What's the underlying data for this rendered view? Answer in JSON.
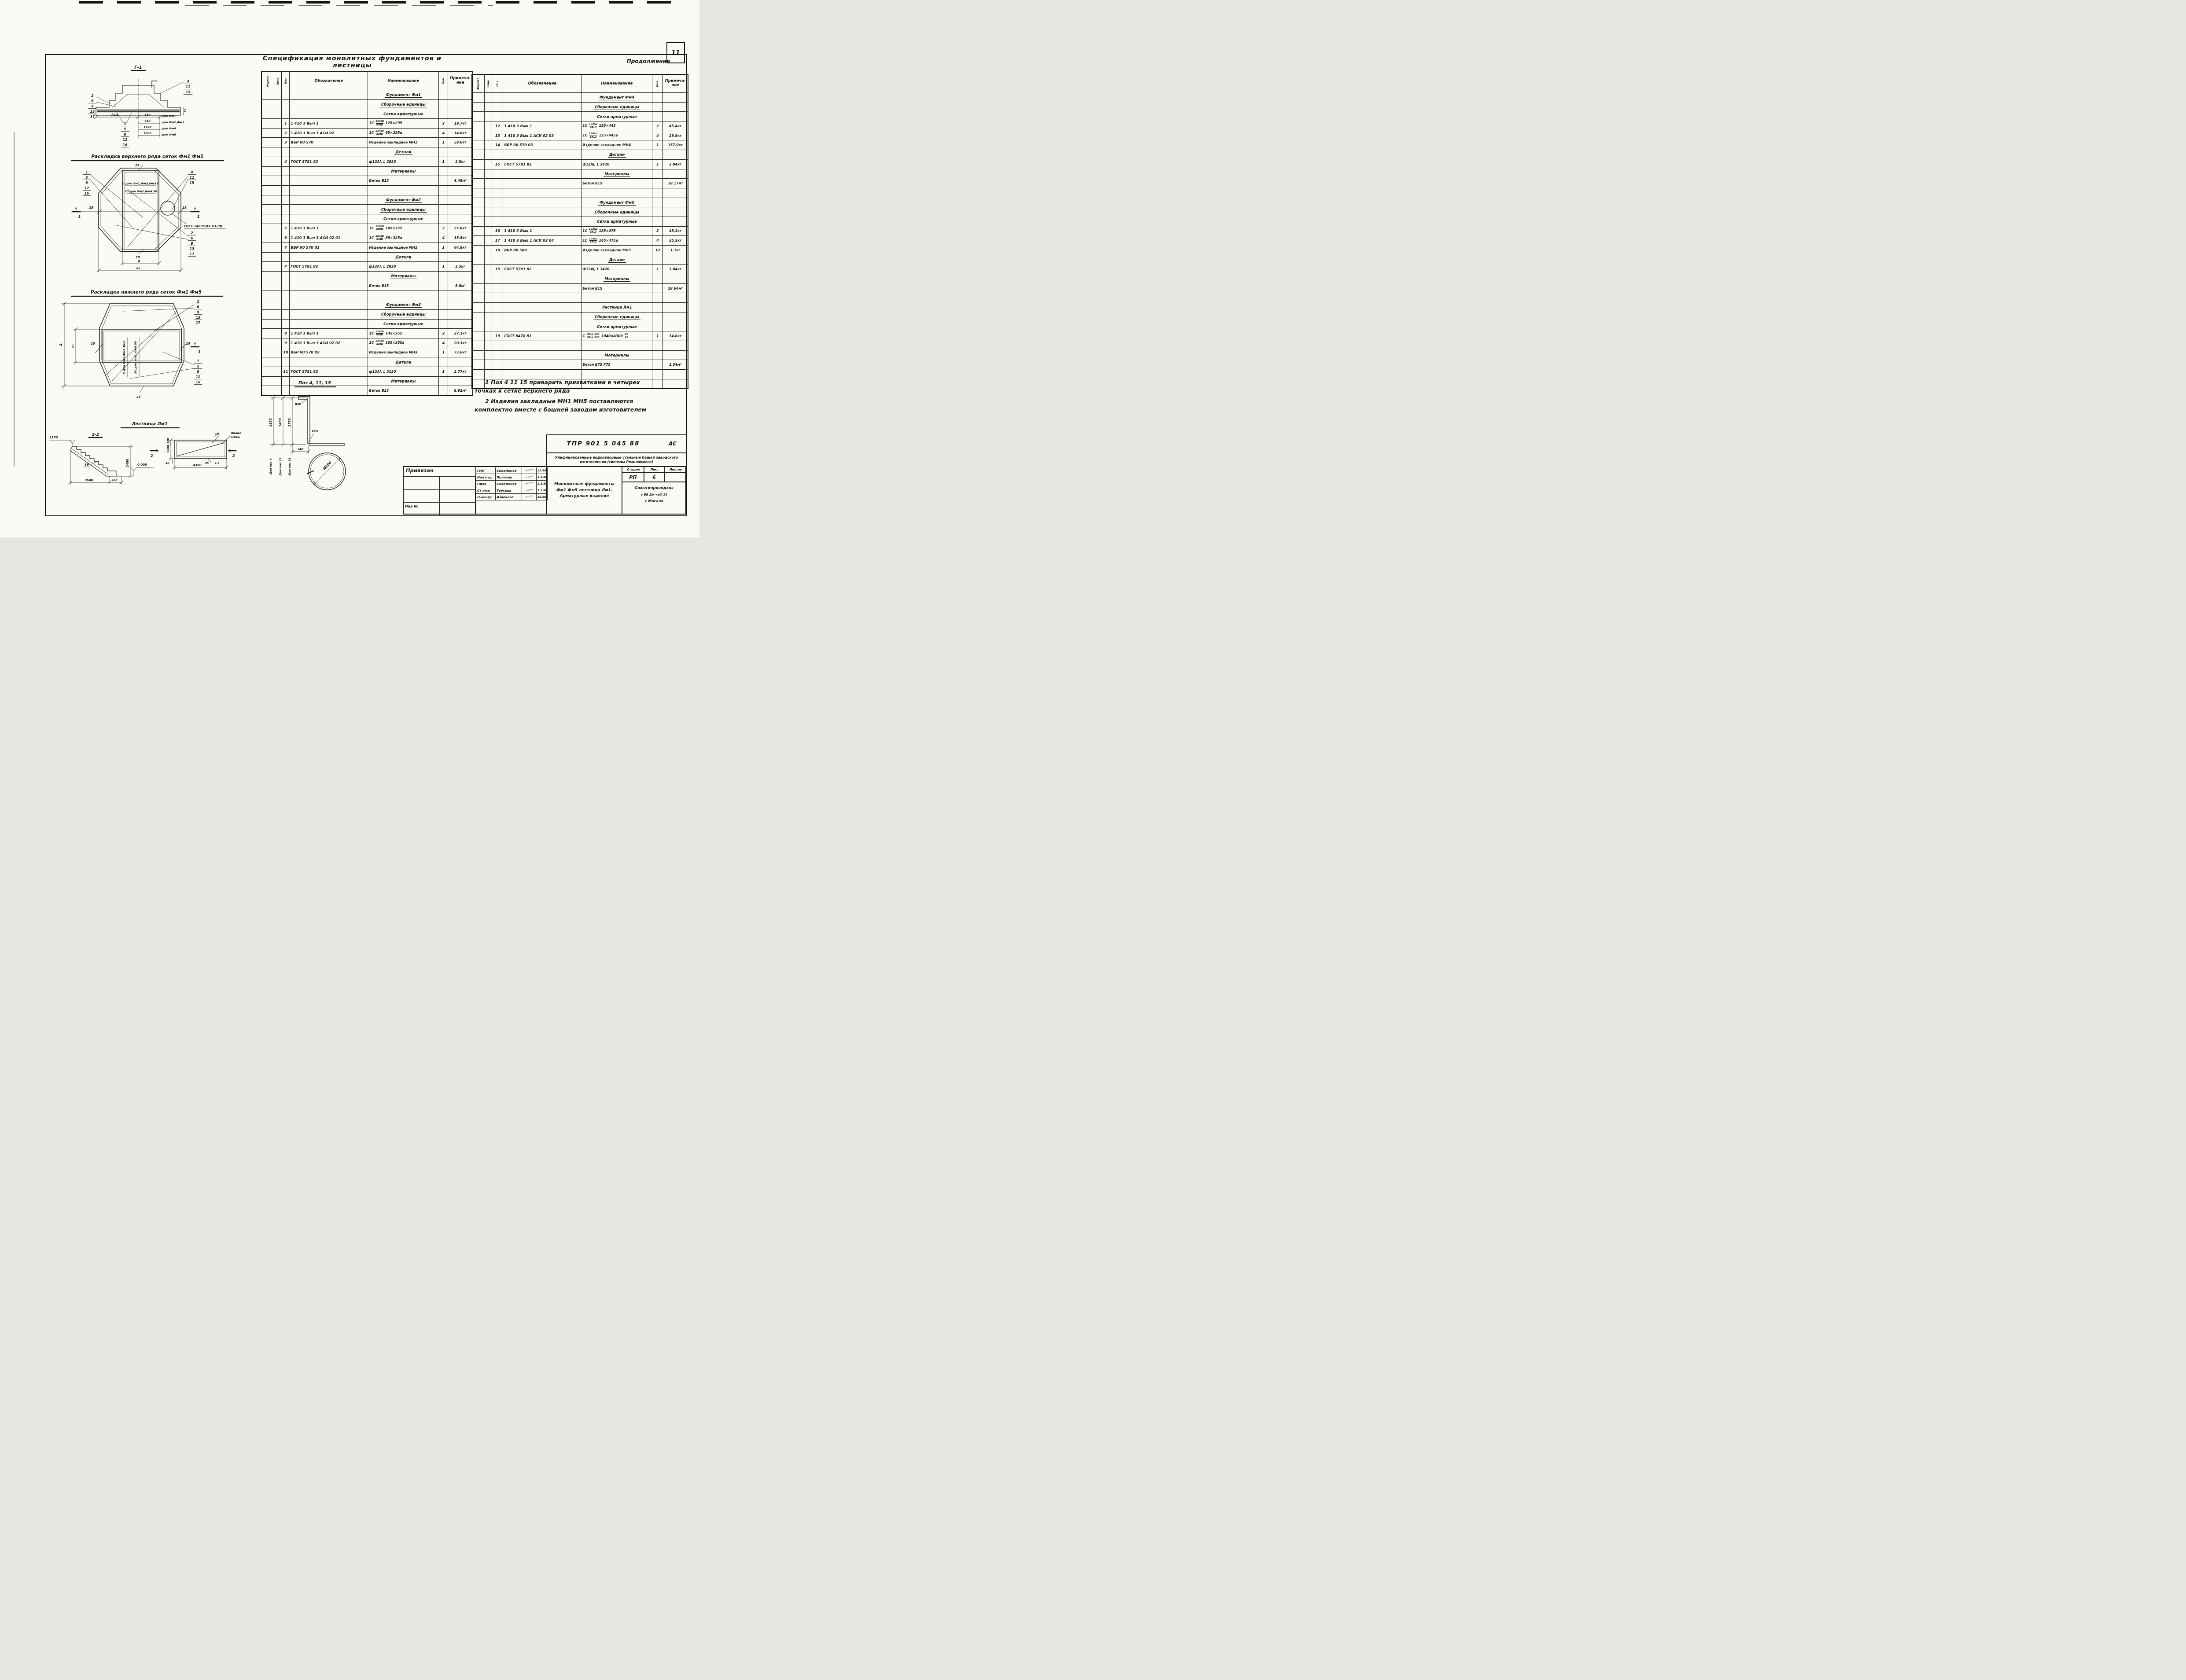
{
  "page": {
    "number": "11",
    "continuation_label": "Продолжение",
    "title": "Спецификация монолитных фундаментов и лестницы"
  },
  "spec_table": {
    "headers": {
      "format": "Формат",
      "zona": "Зона",
      "poz": "Поз",
      "oboznachenie": "Обозначение",
      "naimenovanie": "Наименование",
      "kol": "Кол",
      "primechanie": "Примеча-\nние"
    },
    "left_rows": [
      {
        "t": "s",
        "na": "Фундамент Фм1"
      },
      {
        "t": "s",
        "na": "Сборочные единицы"
      },
      {
        "t": "sp",
        "na": "Сетки арматурные"
      },
      {
        "t": "i",
        "poz": "1",
        "ob": "1 410 3 Вып 1",
        "na": "1С {12АШ|6АШ} 125×295",
        "kol": "2",
        "pr": "19.7кг"
      },
      {
        "t": "i",
        "poz": "2",
        "ob": "1 410 3 Вып 1  АСИ 02",
        "na": "1С {12АШ|6АШ} 85×295а",
        "kol": "4",
        "pr": "14.0кг"
      },
      {
        "t": "i",
        "poz": "3",
        "ob": "ВБР 00 570",
        "na": "Изделие закладное МН1",
        "kol": "1",
        "pr": "58.0кг"
      },
      {
        "t": "s",
        "na": "Детали"
      },
      {
        "t": "i",
        "poz": "4",
        "ob": "ГОСТ 5781 82",
        "na": "ф12АI, L 2820",
        "kol": "1",
        "pr": "2.5кг"
      },
      {
        "t": "s",
        "na": "Материалы"
      },
      {
        "t": "m",
        "na": "Бетон В15",
        "pr": "4.48м³"
      },
      {
        "t": "e"
      },
      {
        "t": "s",
        "na": "Фундамент Фм2"
      },
      {
        "t": "s",
        "na": "Сборочные единицы"
      },
      {
        "t": "sp",
        "na": "Сетки арматурные"
      },
      {
        "t": "i",
        "poz": "5",
        "ob": "1 410 3 Вып 1",
        "na": "1С {12АШ|6АШ} 145×325",
        "kol": "2",
        "pr": "25.0кг"
      },
      {
        "t": "i",
        "poz": "6",
        "ob": "1 410 3 Вып 1  АСИ 02 01",
        "na": "1С {12АШ|6АШ} 85×325а",
        "kol": "4",
        "pr": "15.5кг"
      },
      {
        "t": "i",
        "poz": "7",
        "ob": "ВБР 00 570 01",
        "na": "Изделие закладное МН2",
        "kol": "1",
        "pr": "64.8кг"
      },
      {
        "t": "s",
        "na": "Детали"
      },
      {
        "t": "i",
        "poz": "4",
        "ob": "ГОСТ 5781 82",
        "na": "ф12АI, L 2820",
        "kol": "1",
        "pr": "2.5кг"
      },
      {
        "t": "s",
        "na": "Материалы"
      },
      {
        "t": "m",
        "na": "Бетон В15",
        "pr": "5.8м³"
      },
      {
        "t": "e"
      },
      {
        "t": "s",
        "na": "Фундамент Фм3"
      },
      {
        "t": "s",
        "na": "Сборочные единицы"
      },
      {
        "t": "sp",
        "na": "Сетки арматурные"
      },
      {
        "t": "i",
        "poz": "8",
        "ob": "1 410 3 Вып 1",
        "na": "1С {12АШ|6АШ} 145×355",
        "kol": "2",
        "pr": "27.1кг"
      },
      {
        "t": "i",
        "poz": "9",
        "ob": "1 410 3 Вып 1  АСИ 02 02",
        "na": "1С {12АШ|6АШ} 105×355а",
        "kol": "4",
        "pr": "20.3кг"
      },
      {
        "t": "i",
        "poz": "10",
        "ob": "ВБР 00 570 02",
        "na": "Изделие закладное МН3",
        "kol": "1",
        "pr": "73.6кг"
      },
      {
        "t": "s",
        "na": "Детали"
      },
      {
        "t": "i",
        "poz": "11",
        "ob": "ГОСТ 5781 82",
        "na": "ф12АI, L 3120",
        "kol": "1",
        "pr": "2.77кг"
      },
      {
        "t": "s",
        "na": "Материалы"
      },
      {
        "t": "m",
        "na": "Бетон В15",
        "pr": "8.92м³"
      }
    ],
    "right_rows": [
      {
        "t": "s",
        "na": "Фундамент Фм4"
      },
      {
        "t": "s",
        "na": "Сборочные единицы"
      },
      {
        "t": "sp",
        "na": "Сетки арматурные"
      },
      {
        "t": "i",
        "poz": "12",
        "ob": "1 410 3 Вып 1",
        "na": "1С {12АШ|6АШ} 185×445",
        "kol": "2",
        "pr": "45.4кг"
      },
      {
        "t": "i",
        "poz": "13",
        "ob": "1 410 3 Вып 1  АСИ 02 03",
        "na": "1С {12АШ|6АШ} 125×445а",
        "kol": "4",
        "pr": "29.9кг"
      },
      {
        "t": "i",
        "poz": "14",
        "ob": "ВБР 00 570 03",
        "na": "Изделие закладное МН4",
        "kol": "1",
        "pr": "157.0кг"
      },
      {
        "t": "s",
        "na": "Детали"
      },
      {
        "t": "i",
        "poz": "15",
        "ob": "ГОСТ 5781 82",
        "na": "ф12АI, L 3420",
        "kol": "1",
        "pr": "3.04кг"
      },
      {
        "t": "s",
        "na": "Материалы"
      },
      {
        "t": "m",
        "na": "Бетон В15",
        "pr": "18.17м³"
      },
      {
        "t": "e"
      },
      {
        "t": "s",
        "na": "Фундамент Фм5"
      },
      {
        "t": "s",
        "na": "Сборочные единицы"
      },
      {
        "t": "sp",
        "na": "Сетки арматурные"
      },
      {
        "t": "i",
        "poz": "16",
        "ob": "1 410 3 Вып 1",
        "na": "1С {12АШ|6АШ} 185×475",
        "kol": "2",
        "pr": "48.1кг"
      },
      {
        "t": "i",
        "poz": "17",
        "ob": "1 410 3 Вып 1  АСИ 02 04",
        "na": "1С {12АШ|6АШ} 145×475а",
        "kol": "4",
        "pr": "35.3кг"
      },
      {
        "t": "i",
        "poz": "18",
        "ob": "ВБР 00 580",
        "na": "Изделие закладное МН5",
        "kol": "12",
        "pr": "1.7кг"
      },
      {
        "t": "s",
        "na": "Детали"
      },
      {
        "t": "i",
        "poz": "15",
        "ob": "ГОСТ 5781 82",
        "na": "ф12АI, L 3420",
        "kol": "1",
        "pr": "3.04кг"
      },
      {
        "t": "s",
        "na": "Материалы"
      },
      {
        "t": "m",
        "na": "Бетон В15",
        "pr": "28.64м³"
      },
      {
        "t": "e"
      },
      {
        "t": "s",
        "na": "Лестница Лм1"
      },
      {
        "t": "s",
        "na": "Сборочные единицы"
      },
      {
        "t": "sp",
        "na": "Сетки арматурные"
      },
      {
        "t": "i",
        "poz": "19",
        "ob": "ГОСТ 8478 81",
        "na": "С {5ВрI 100|5ВрI 100} 1040×4300 {50|20}",
        "kol": "1",
        "pr": "14.0кг"
      },
      {
        "t": "e"
      },
      {
        "t": "s",
        "na": "Материалы"
      },
      {
        "t": "m",
        "na": "Бетон В75 F75",
        "pr": "1.54м³"
      },
      {
        "t": "e"
      },
      {
        "t": "e"
      }
    ]
  },
  "notes": [
    "1 Поз 4 11 15 приварить прихватками в четырех точках к сетке верхнего ряда",
    "2 Изделия закладные МН1 МН5 поставляются комплектно вместе с башней заводом изготовителем"
  ],
  "drawings": {
    "section_g1": {
      "title": "Г-1",
      "callout_top": [
        "4",
        "11",
        "15"
      ],
      "callout_left": [
        "2",
        "6",
        "9",
        "13",
        "17"
      ],
      "callout_bottom": [
        "1",
        "5",
        "8",
        "12",
        "16"
      ],
      "dim_half": "А₁/2",
      "dim_cover": "35",
      "dim_table": [
        {
          "value": "830",
          "for": "для Фм1"
        },
        {
          "value": "910",
          "for": "для Фм2,Фм3"
        },
        {
          "value": "1228",
          "for": "для Фм4"
        },
        {
          "value": "1860",
          "for": "для Фм5"
        }
      ]
    },
    "top_mesh": {
      "title": "Раскладка верхнего ряда сеток Фм1 Фм5",
      "callout_left": [
        "1",
        "5",
        "8",
        "12",
        "16"
      ],
      "callout_right_top": [
        "4",
        "11",
        "15"
      ],
      "callout_right_bottom": [
        "2",
        "6",
        "9",
        "13",
        "17"
      ],
      "dim_top": "25",
      "dim_left": "25",
      "dim_right": "25",
      "dim_bottom": "25",
      "dim_a": "а",
      "dim_a1": "А₁",
      "annotation_1": "0 для Фм1,Фм3,Фм5 0",
      "annotation_2": "50 для Фм2,Фм4 50",
      "weld_label": "ГОСТ 14098-85-К3-Рр",
      "section_mark": "1"
    },
    "bottom_mesh": {
      "title": "Раскладка нижнего ряда сеток Фм1 Фм5",
      "callout_right_top": [
        "2",
        "6",
        "9",
        "13",
        "17"
      ],
      "callout_right_bottom": [
        "1",
        "5",
        "8",
        "12",
        "16"
      ],
      "dim_A": "А",
      "dim_a1": "а₁",
      "dim_left": "25",
      "dim_right": "25",
      "dim_bottom": "25",
      "annotation_1": "0 для Фм1 Фм3 Фм5",
      "annotation_2": "50 для Фм2 Фм4 50",
      "section_mark": "1"
    },
    "ladder": {
      "title": "Лестница Лм1",
      "section_label": "2-2",
      "level_top": "2150",
      "level_zero": "0 000",
      "dim_height": "2450",
      "dim_run": "3640",
      "dim_toe": "260",
      "callout": "19",
      "plan_callout": "19",
      "fold_line_1": "Линия",
      "fold_line_2": "сгиба",
      "dim_plan_width": "4390",
      "dim_plan_height": "1300",
      "dim_plan_top": "130",
      "dim_plan_bottom": "45",
      "dim_plan_right": "25",
      "dim_plan_thk": "1.5",
      "section_mark": "2"
    },
    "bar_detail": {
      "title": "Поз 4, 11, 15",
      "radius_top": "R20",
      "radius_bottom": "R20",
      "dim_offset": "140",
      "lengths": [
        {
          "len": "1150",
          "for": "Для поз 4"
        },
        {
          "len": "1450",
          "for": "Для поз 11"
        },
        {
          "len": "1750",
          "for": "Для поз 15"
        }
      ],
      "diameter": "Ø500"
    }
  },
  "title_block": {
    "doc_number": "ТПР 901 5 045 88",
    "mark": "АС",
    "project": "Унифицированные водонапорные стальные башни заводского изготовления (системы Рожновского)",
    "sheet_title": "Монолитные фундаменты Фм1 Фм5 лестница Лм1. Арматурные изделия",
    "stage_label": "Стадия",
    "sheet_label": "Лист",
    "sheets_label": "Листов",
    "stage": "РП",
    "sheet": "6",
    "org": "Союзгипроводхоз",
    "org_line2": "у ЕЕ Дм-ке3 18",
    "city": "г Москва",
    "binding": "Привязан",
    "inv_label": "Инв №",
    "signatures": [
      {
        "role": "ГИП",
        "name": "Селеменов",
        "date": "22.88"
      },
      {
        "role": "Нач отд",
        "name": "Поляков",
        "date": "2.2.88"
      },
      {
        "role": "Пров",
        "name": "Селеменов",
        "date": "2.2.88"
      },
      {
        "role": "Ст инж",
        "name": "Трусова",
        "date": "1.2.88"
      },
      {
        "role": "Н.контр",
        "name": "Извекова",
        "date": "12.88"
      }
    ]
  }
}
